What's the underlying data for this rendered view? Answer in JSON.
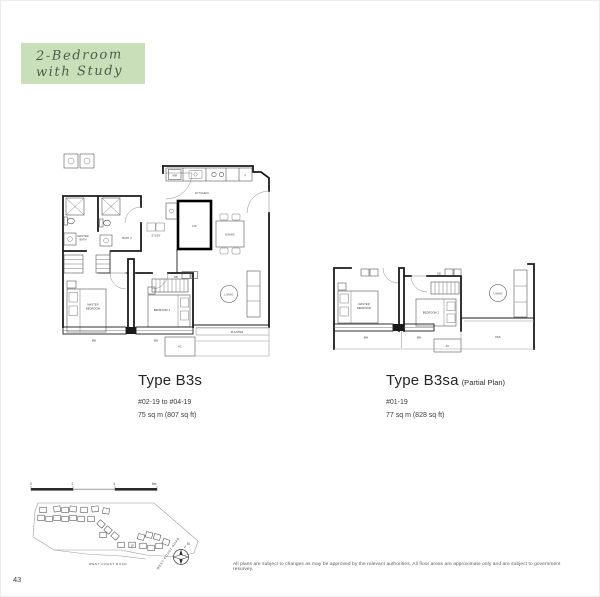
{
  "page": {
    "number": "43",
    "disclaimer": "All plans are subject to changes as may be approved by the relevant authorities. All floor areas are approximate only and are subject to government resurvey."
  },
  "badge": {
    "line1": "2-Bedroom",
    "line2": "with Study",
    "bg_color": "#c9dfba",
    "text_color": "#4c5c49"
  },
  "plans": {
    "b3s": {
      "title": "Type B3s",
      "units": "#02-19 to #04-19",
      "area": "75 sq m (807 sq ft)"
    },
    "b3sa": {
      "title": "Type B3sa",
      "title_suffix": "(Partial Plan)",
      "units": "#01-19",
      "area": "77 sq m (828 sq ft)"
    }
  },
  "labels": {
    "wm": "WM",
    "fridge": "F",
    "kitchen": "KITCHEN",
    "hs": "HS",
    "dining": "DINING",
    "study": "STUDY",
    "master_bath": [
      "MASTER",
      "BATH"
    ],
    "bath_2": "BATH 2",
    "db": "DB",
    "master_bedroom": [
      "MASTER",
      "BEDROOM"
    ],
    "bedroom_2": "BEDROOM 2",
    "living": "LIVING",
    "planter": "PLANTER",
    "pes": "PES",
    "ac": "AC",
    "bw": "BW"
  },
  "site_map": {
    "scale_ticks": [
      "0",
      "2",
      "4",
      "6m"
    ],
    "road_bottom": "WEST COAST ROAD",
    "road_right": "WEST COAST ROAD",
    "compass_label": "N",
    "highlighted_stack": "19",
    "highlight_color": "#b9d69c"
  }
}
